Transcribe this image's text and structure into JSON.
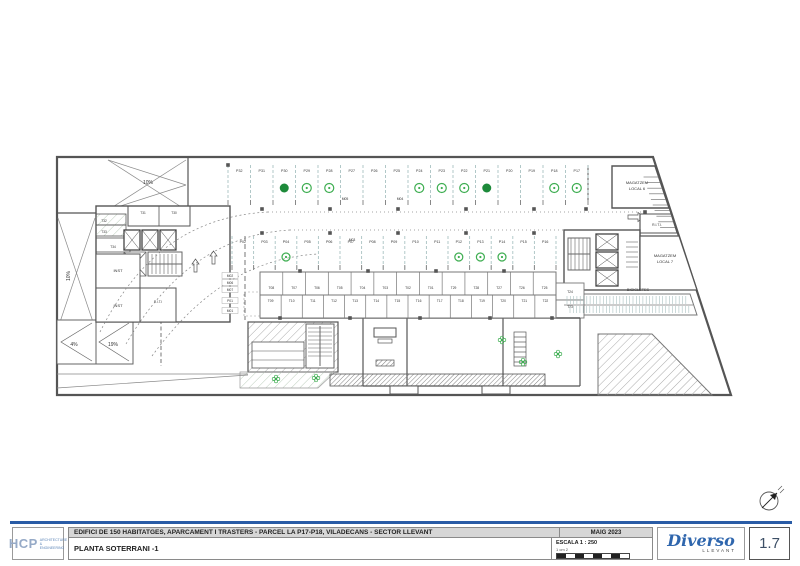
{
  "title_block": {
    "project_title": "EDIFICI DE 150 HABITATGES, APARCAMENT I TRASTERS - PARCEL LA P17-P18, VILADECANS - SECTOR LLEVANT",
    "drawing_title": "PLANTA SOTERRANI -1",
    "date": "MAIG 2023",
    "scale": "ESCALA 1 : 250",
    "scale_bar_label": "1 cm 2",
    "sheet_number": "1.7"
  },
  "logos": {
    "hcp_name": "HCP",
    "hcp_tagline1": "ARCHITECTURE",
    "hcp_tagline2": "& ENGINEERING",
    "diverso_name": "Diverso",
    "diverso_sub": "LLEVANT"
  },
  "plan": {
    "rooms": {
      "magatzem6_l1": "MAGATZEM",
      "magatzem6_l2": "LOCAL 6",
      "magatzem7_l1": "MAGATZEM",
      "magatzem7_l2": "LOCAL 7",
      "bicicletes": "BICICLETES",
      "riti_top": "R.I.T.I.",
      "riti_left": "R.I.T.I",
      "inst_1": "INST",
      "inst_2": "INST"
    },
    "ramps": {
      "top": "10%",
      "left": "10%",
      "low1": "4%",
      "low2": "19%"
    },
    "parking_top_row": [
      "P32",
      "P31",
      "P30",
      "P29",
      "P28",
      "P27",
      "P26",
      "P25",
      "P24",
      "P23",
      "P22",
      "P21",
      "P20",
      "P19",
      "P18",
      "P17"
    ],
    "parking_mid_row": [
      "P02",
      "P03",
      "P04",
      "P05",
      "P06",
      "P07",
      "P08",
      "P09",
      "P10",
      "P11",
      "P12",
      "P13",
      "P14",
      "P15",
      "P16"
    ],
    "side_labels": [
      "M02",
      "M06",
      "M07",
      "P01",
      "M01"
    ],
    "moto_labels_top": [
      "M05",
      "M04",
      "M03"
    ],
    "trasters_upper": [
      "T08",
      "T07",
      "T06",
      "T05",
      "T04",
      "T03",
      "T02",
      "T01",
      "T29",
      "T28",
      "T27",
      "T26",
      "T25"
    ],
    "trasters_lower": [
      "T09",
      "T10",
      "T11",
      "T12",
      "T13",
      "T14",
      "T15",
      "T16",
      "T17",
      "T18",
      "T19",
      "T20",
      "T21",
      "T22"
    ],
    "trasters_right": [
      "T24",
      "T23"
    ],
    "trasters_core_top": [
      "T31",
      "T30"
    ],
    "trasters_core_left": [
      "T32",
      "T33",
      "T34"
    ],
    "green_marks": {
      "top": [
        {
          "stall": "P30",
          "style": "filled"
        },
        {
          "stall": "P29",
          "style": "ring"
        },
        {
          "stall": "P28",
          "style": "ring"
        },
        {
          "stall": "P24",
          "style": "ring"
        },
        {
          "stall": "P23",
          "style": "ring"
        },
        {
          "stall": "P22",
          "style": "ring"
        },
        {
          "stall": "P21",
          "style": "filled"
        },
        {
          "stall": "P18",
          "style": "ring"
        },
        {
          "stall": "P17",
          "style": "ring"
        }
      ],
      "mid": [
        {
          "stall": "P04",
          "style": "ring"
        },
        {
          "stall": "P12",
          "style": "ring"
        },
        {
          "stall": "P13",
          "style": "ring"
        },
        {
          "stall": "P14",
          "style": "ring"
        }
      ]
    }
  },
  "colors": {
    "accent_blue": "#2a5ca6",
    "diverso_blue": "#2f66ad",
    "green_filled": "#1d8a3a",
    "green_ring": "#3fae52",
    "wall_gray": "#555555",
    "stall_line_teal": "#a9c2c2",
    "titlebar_gray": "#d6d6d6"
  }
}
